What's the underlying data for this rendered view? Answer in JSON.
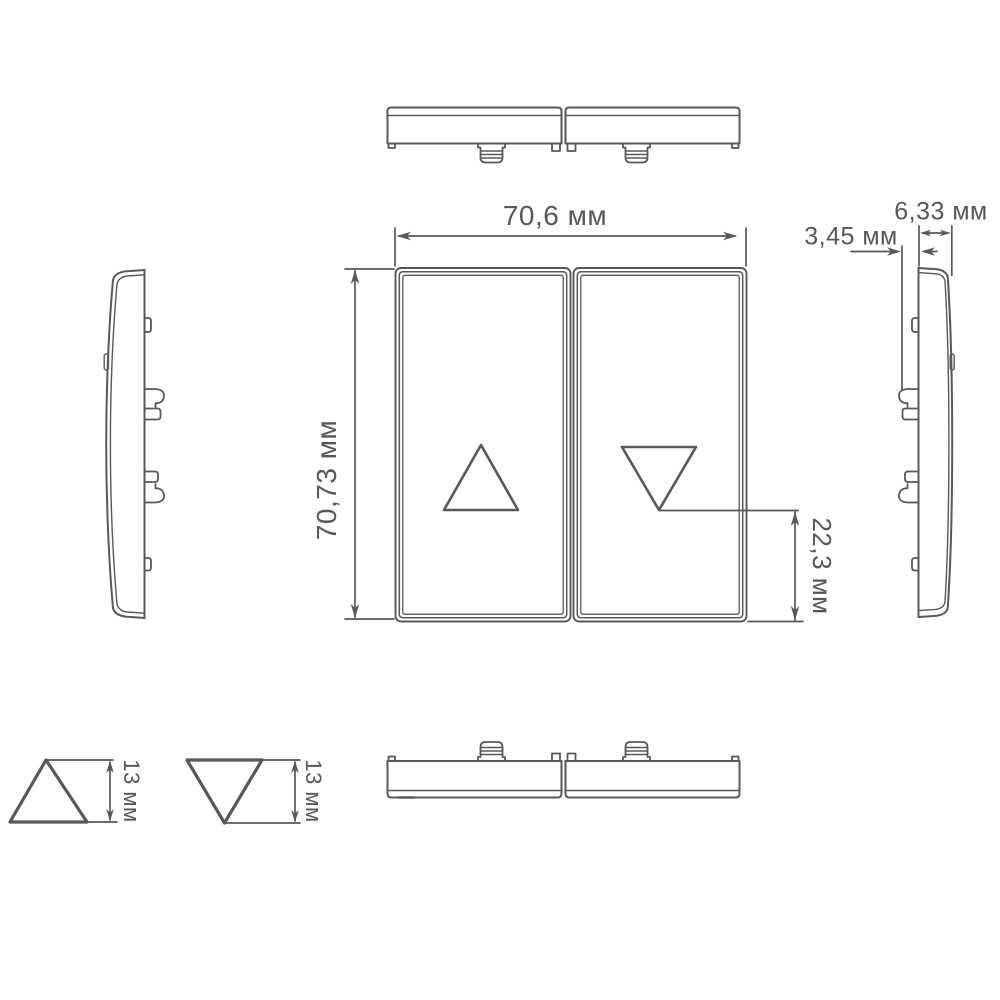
{
  "style": {
    "line_color": "#58585a",
    "background": "#ffffff"
  },
  "labels": {
    "front_width": "70,6 мм",
    "front_height": "70,73 мм",
    "clip_protrusion": "3,45 мм",
    "side_thickness": "6,33 мм",
    "arrow_to_bottom": "22,3 мм",
    "up_arrow_height": "13 мм",
    "down_arrow_height": "13 мм"
  }
}
